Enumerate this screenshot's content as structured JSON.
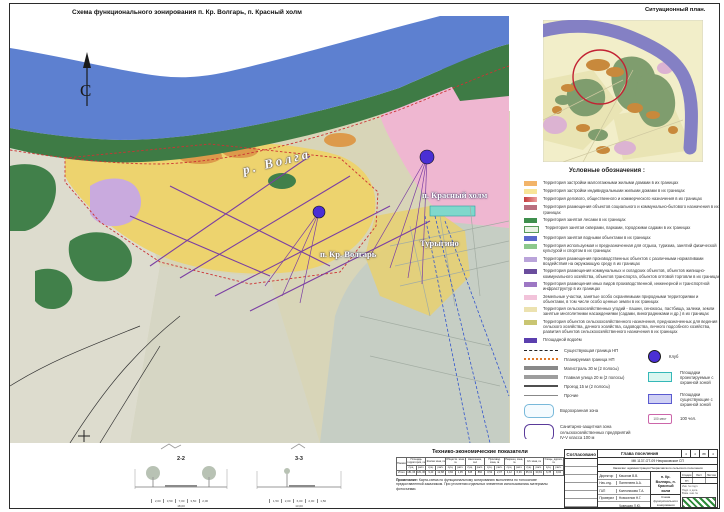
{
  "page": {
    "title": "Схема функционального зонирования п. Кр. Волгарь, п. Красный холм",
    "situational_title": "Ситуационный план."
  },
  "map": {
    "north_label": "С",
    "labels": {
      "river": "р. Волга",
      "krasny_kholm": "п. Красный холм",
      "turygino": "Турыгино",
      "kr_volgar": "п. Кр. Волгарь"
    },
    "colors": {
      "river": "#5d80d0",
      "shore_green": "#3e7b45",
      "residential_yellow": "#edd36e",
      "planned_pink": "#efb7d1",
      "topo_gray": "#c6cec4",
      "road_purple": "#7b3fa3",
      "boundary_red": "#cc3333",
      "marker_violet": "#4a2fd4"
    }
  },
  "legend": {
    "title": "Условные обозначения :",
    "zones": [
      {
        "bg": "#f2b469",
        "label": "Территория застройки малоэтажными жилыми домами в их границах"
      },
      {
        "bg": "#f8e598",
        "label": "Территория застройки индивидуальными жилыми домами в их границах"
      },
      {
        "bg": "linear-gradient(90deg,#c43c3c,#eda0a0)",
        "label": "Территория делового, общественного и коммерческого назначения в их границах"
      },
      {
        "bg": "#b96e7e",
        "label": "Территория размещения объектов социального и коммунально-бытового назначения в их границах"
      },
      {
        "bg": "#3f8f4d",
        "label": "Территория занятая лесами в их границах"
      },
      {
        "bg": "#eaf4e6",
        "bd": "0.8px solid #5a9a5a",
        "label": "Территория занятая скверами, парками, городскими садами в их границах"
      },
      {
        "bg": "#5a68cc",
        "label": "Территория занятая водными объектами в их границах"
      },
      {
        "bg": "#8cc88c",
        "label": "Территория используемая и предназначенная для отдыха, туризма, занятий физической культурой и спортом в их границах"
      },
      {
        "bg": "#baa4da",
        "label": "Территория размещения производственных объектов с различными нормативами воздействия на окружающую среду в их границах"
      },
      {
        "bg": "#6a4d9d",
        "label": "Территория размещения коммунальных и складских объектов, объектов жилищно-коммунального хозяйства, объектов транспорта, объектов оптовой торговли в их границах"
      },
      {
        "bg": "#9d77c4",
        "label": "Территория размещения иных видов производственной, инженерной и транспортной инфраструктур в их границах"
      },
      {
        "bg": "#f2c3da",
        "label": "Земельные участки, занятые особо охраняемыми природными территориями и объектами, в том числе особо ценные земли в их границах"
      },
      {
        "bg": "#ece2b0",
        "label": "Территория сельскохозяйственных угодий - пашни, сенокосы, пастбища, залежи, земли занятые многолетними насаждениями (садами, виноградниками и др.) в их границах"
      },
      {
        "bg": "#c9c572",
        "label": "Территория объектов сельскохозяйственного назначения, предназначенных для ведения сельского хозяйства, дачного хозяйства, садоводства, личного подсобного хозяйства, развития объектов сельскохозяйственного назначения в их границах"
      },
      {
        "bg": "#5b3fae",
        "label": "Площадной водоём"
      }
    ],
    "lines": [
      {
        "cls": "sw-dash",
        "label": "Существующая граница НП"
      },
      {
        "cls": "sw-dots",
        "label": "Планируемая граница НП"
      },
      {
        "cls": "sw-bar-thick",
        "label": "Магистраль 30 м (2 полосы)"
      },
      {
        "cls": "sw-bar-med",
        "label": "Главная улица 20 м (2 полосы)"
      },
      {
        "cls": "sw-bar-thin",
        "label": "Проезд 15 м (2 полосы)"
      },
      {
        "cls": "sw-line",
        "label": "Прочие"
      }
    ],
    "areas": [
      {
        "cls": "zn-water",
        "label": "Водоохранная зона"
      },
      {
        "cls": "zn-san",
        "label": "Санитарно-защитная зона сельскохозяйственных предприятий IV-V класса 100 м"
      }
    ],
    "points": [
      {
        "cls": "pt-circle",
        "label": "Клуб"
      },
      {
        "cls": "pt-rect-cyan",
        "label": "Площадки проектируемые с охранной зоной"
      },
      {
        "cls": "pt-rect-blue",
        "label": "Площадки существующие с охранной зоной"
      },
      {
        "cls": "pt-box",
        "symbol_text": "100 мест",
        "label": "100 чел."
      }
    ]
  },
  "sections": [
    {
      "id": "2-2",
      "dims": [
        "2,00",
        "3,50",
        "7,00",
        "3,50",
        "2,00"
      ],
      "total": "18,00"
    },
    {
      "id": "3-3",
      "dims": [
        "1,50",
        "2,00",
        "6,00",
        "2,00",
        "1,50"
      ],
      "total": "13,00"
    }
  ],
  "table": {
    "title": "Технико-экономические показатели",
    "corner": "Показатели",
    "row_label": "Итого",
    "sub1": "сущ.",
    "sub2": "расч.",
    "groups": [
      "Площадь территории, га",
      "Жилая зона, га",
      "Обществ. зона, га",
      "Население, чел",
      "Производ. зона, га",
      "Рекреац. зона, га",
      "С/х зона, га",
      "Улицы, дороги, га"
    ],
    "values": [
      "181,36",
      "181,36",
      "9,43",
      "12,88",
      "0,84",
      "1,95",
      "645",
      "860",
      "0,52",
      "2,07",
      "4,12",
      "6,36",
      "35,61",
      "30,81",
      "6,78",
      "9,02"
    ],
    "note_label": "Примечание:",
    "note": "Карта-схема по функциональному зонированию выполнена по топооснове предоставленной заказчиком. При уточнении отдельных элементов использовались материалы фотосъемки."
  },
  "titleblock": {
    "approved": "Согласовано",
    "head": "Глава поселения",
    "pages": [
      "4",
      "4",
      "88",
      "4"
    ],
    "doc_code": "МК 1137-ОТ-09 Некрасовское СП",
    "customer": "Заказчик: администрация Некрасовского сельского поселения",
    "object": "п. Кр. Волгарь, п. Красный холм",
    "stage_label": "Стадия",
    "sheet_label": "Лист",
    "sheets_label": "Листов",
    "stage": "ГП",
    "sheet_title": "Схема функционального зонирования (совмещенная схема)",
    "signatures": [
      {
        "role": "Директор",
        "name": "Качалов В.В."
      },
      {
        "role": "Нач.отд.",
        "name": "Пантелеев А.А."
      },
      {
        "role": "ГАП",
        "name": "Колесникова Т.А."
      },
      {
        "role": "Проверил",
        "name": "Новоселов Н.Г."
      },
      {
        "role": "",
        "name": "Чудецкая Л.Ю."
      },
      {
        "role": "",
        "name": "Пискунова И.Ф."
      }
    ],
    "org_lines": [
      "Инв. № подл.",
      "Подп. и дата",
      "Взам. инв. №"
    ]
  }
}
